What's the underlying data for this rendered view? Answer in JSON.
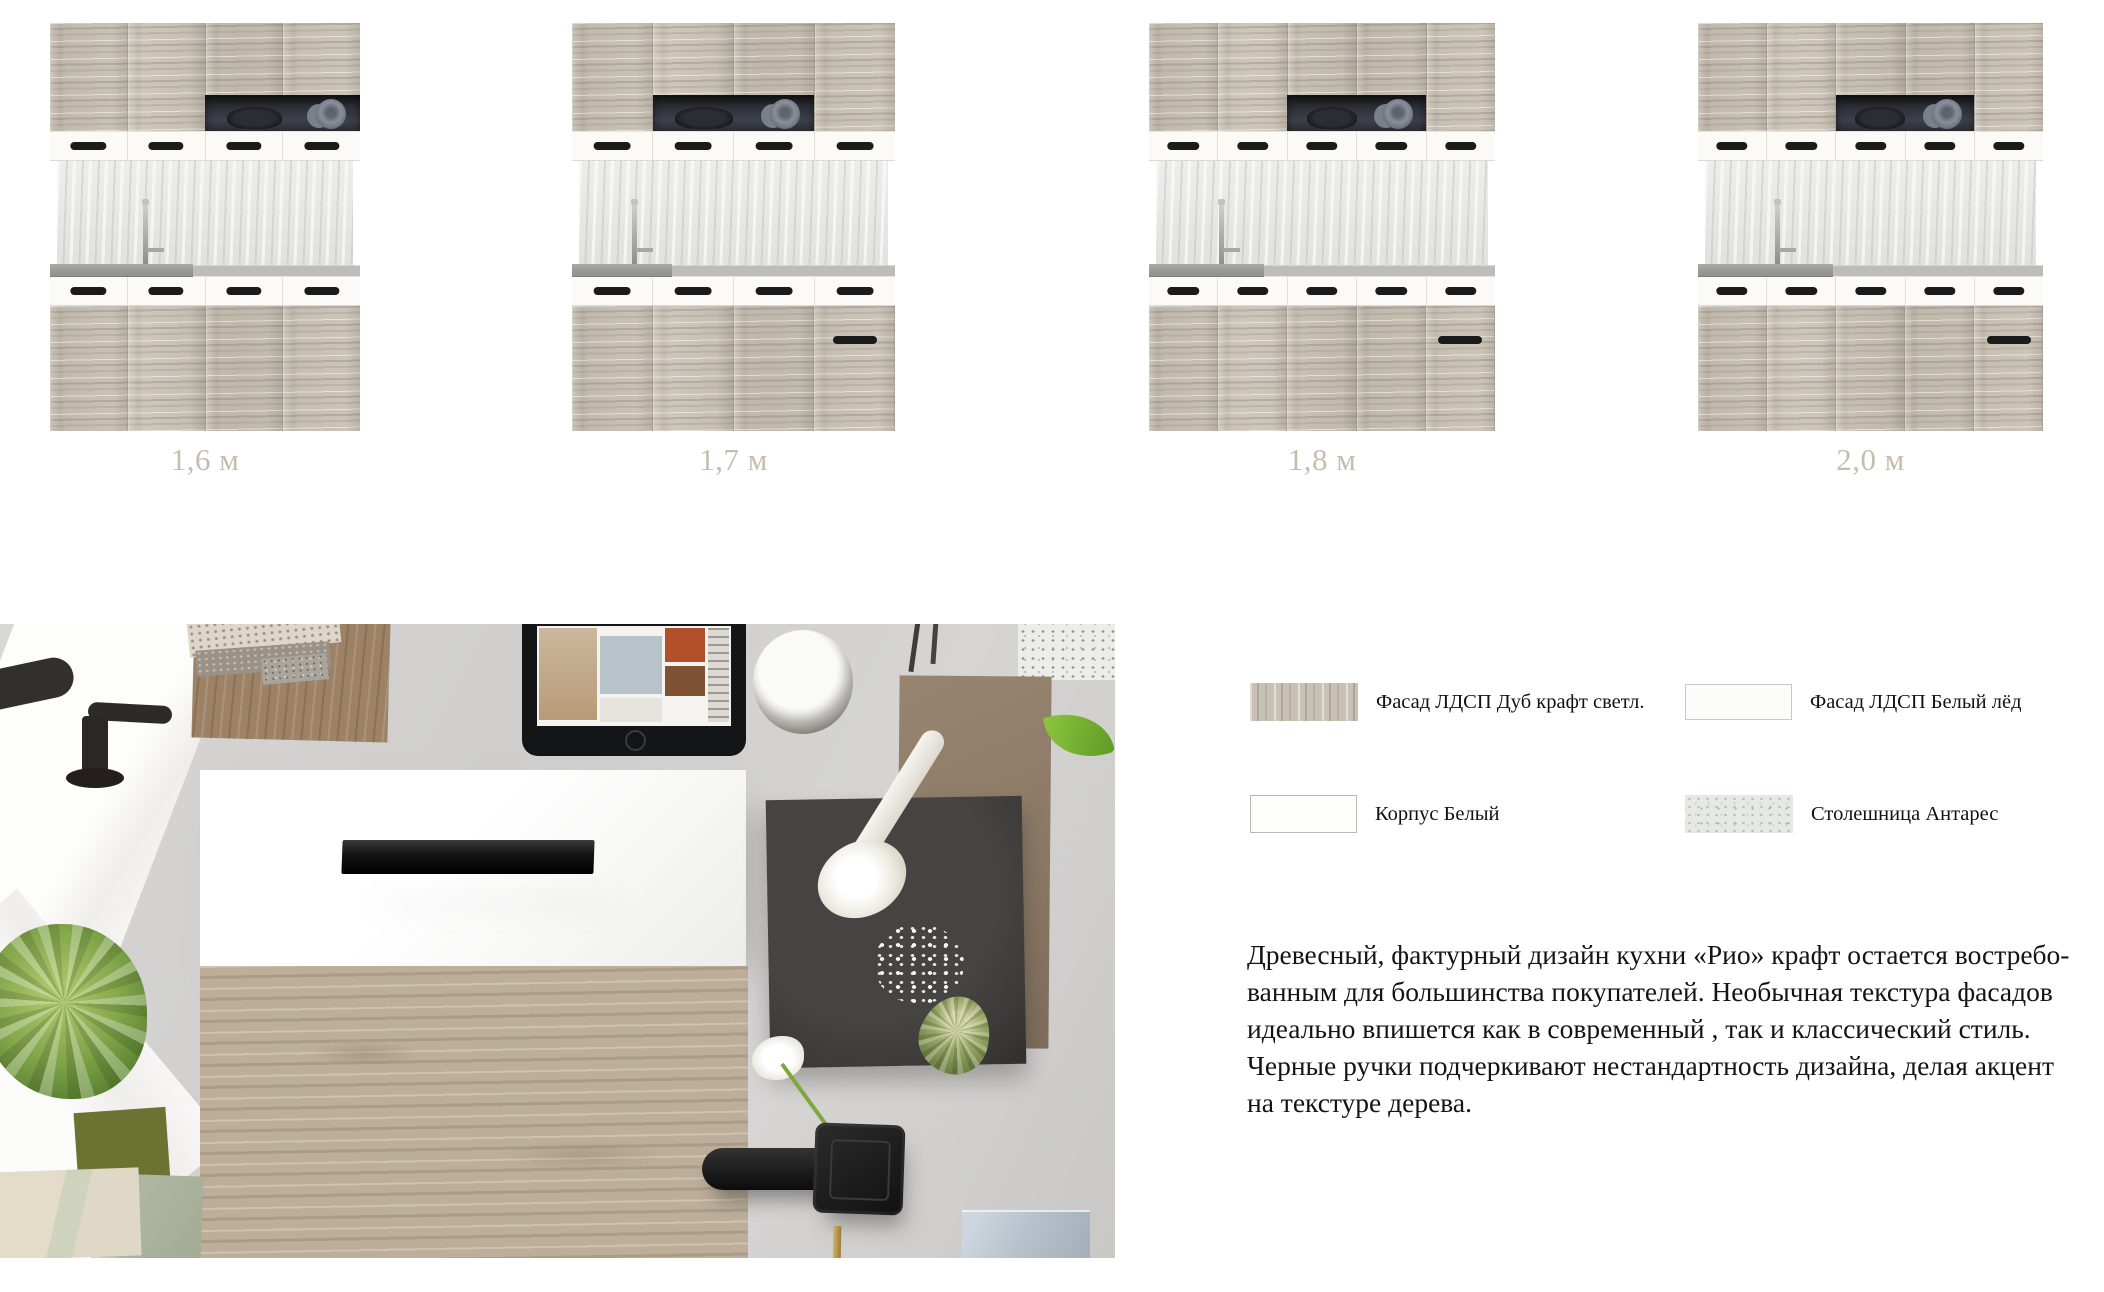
{
  "sizes": [
    {
      "label": "1,6 м",
      "left": 50,
      "width": 310,
      "cols": 4,
      "shelf_start": 2,
      "shelf_end": 3,
      "sink_w": 0.47,
      "faucet_x": 0.29,
      "extra_drawer_handle": false
    },
    {
      "label": "1,7 м",
      "left": 572,
      "width": 323,
      "cols": 4,
      "shelf_start": 1,
      "shelf_end": 2,
      "sink_w": 0.32,
      "faucet_x": 0.17,
      "extra_drawer_handle": true
    },
    {
      "label": "1,8 м",
      "left": 1149,
      "width": 346,
      "cols": 5,
      "shelf_start": 2,
      "shelf_end": 3,
      "sink_w": 0.34,
      "faucet_x": 0.19,
      "extra_drawer_handle": true
    },
    {
      "label": "2,0 м",
      "left": 1698,
      "width": 345,
      "cols": 5,
      "shelf_start": 2,
      "shelf_end": 3,
      "sink_w": 0.4,
      "faucet_x": 0.21,
      "extra_drawer_handle": true
    }
  ],
  "materials": [
    {
      "name": "Фасад ЛДСП Дуб крафт светл.",
      "swatch": "oak-craft"
    },
    {
      "name": "Фасад ЛДСП Белый лёд",
      "swatch": "white-ice"
    },
    {
      "name": "Корпус Белый",
      "swatch": "white"
    },
    {
      "name": "Столешница Антарес",
      "swatch": "antares"
    }
  ],
  "description": {
    "lines": [
      "Древесный, фактурный дизайн кухни «Рио» крафт остается востребо-",
      "ванным для большинства покупателей. Необычная текстура фасадов",
      "идеально впишется как в современный , так и классический стиль.",
      "Черные ручки подчеркивают нестандартность  дизайна, делая акцент",
      "на текстуре дерева."
    ]
  },
  "colors": {
    "size_label": "#c7bdaf",
    "body_text": "#141414",
    "handle": "#1b1b1b",
    "wood_base": "#c9c1b4",
    "countertop": "#bcbcba"
  }
}
